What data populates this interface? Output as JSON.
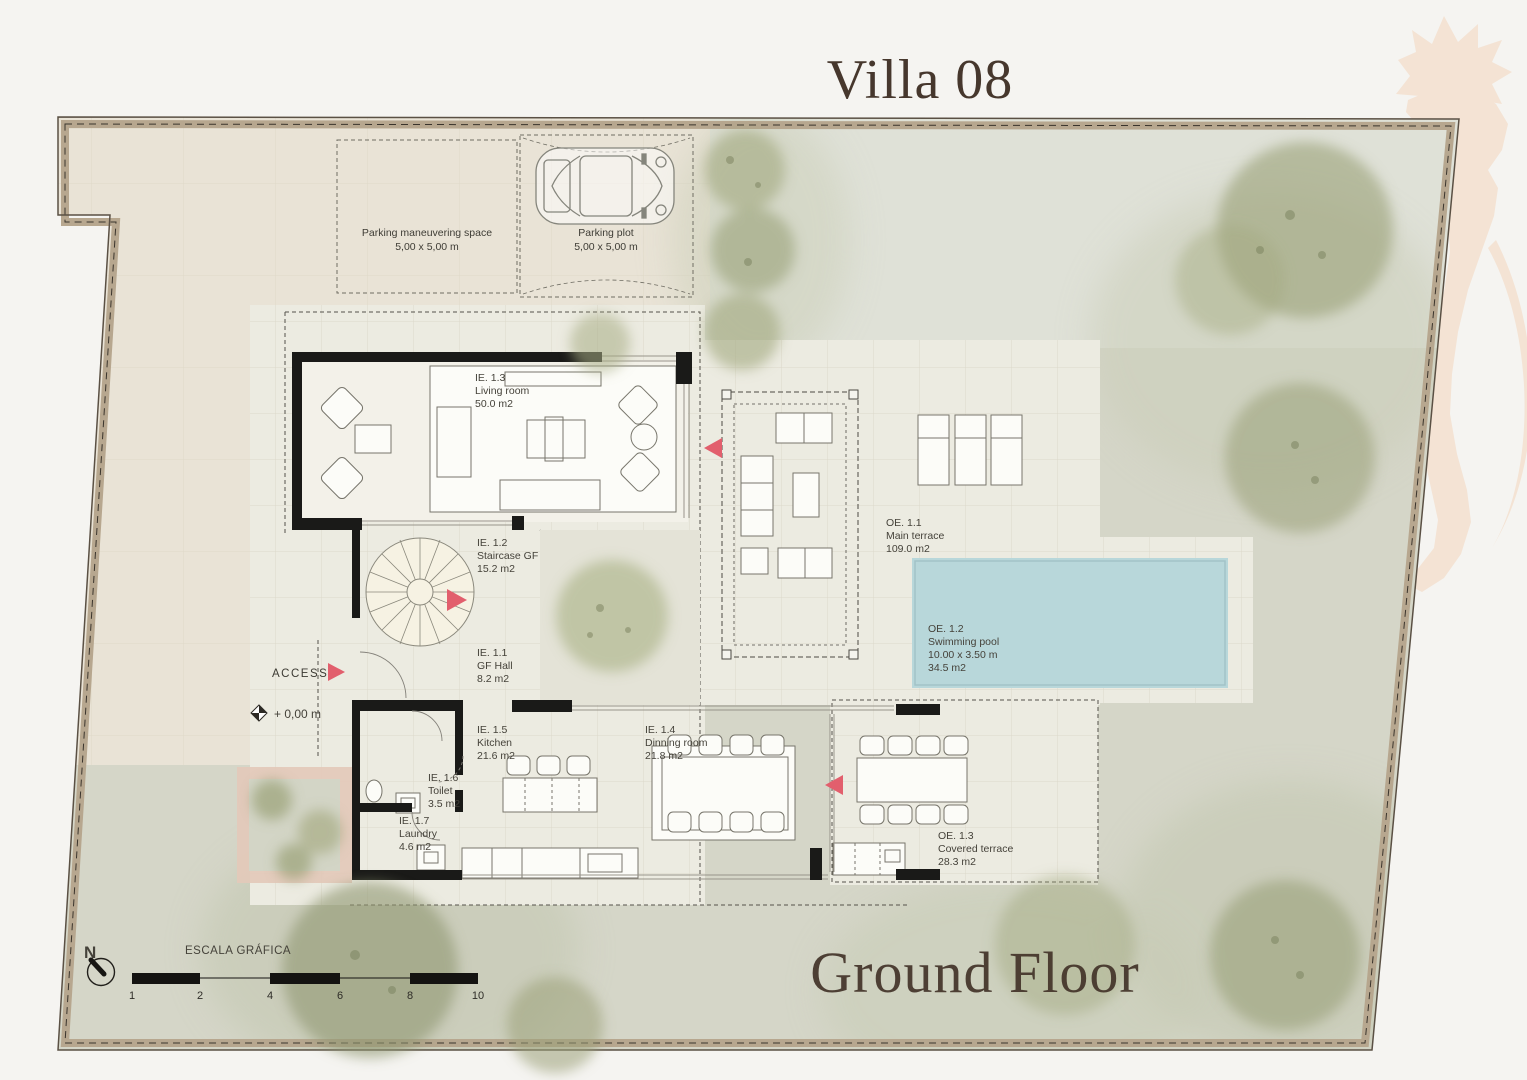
{
  "title": "Villa 08",
  "floor_label": "Ground Floor",
  "logo": "seahorse-watermark",
  "parking": {
    "maneuvering": {
      "name": "Parking maneuvering space",
      "size": "5,00 x 5,00 m"
    },
    "plot": {
      "name": "Parking plot",
      "size": "5,00 x 5,00 m"
    }
  },
  "rooms": {
    "hall": {
      "code": "IE. 1.1",
      "name": "GF Hall",
      "area": "8.2 m2"
    },
    "staircase": {
      "code": "IE. 1.2",
      "name": "Staircase GF",
      "area": "15.2 m2"
    },
    "living": {
      "code": "IE. 1.3",
      "name": "Living room",
      "area": "50.0 m2"
    },
    "dining": {
      "code": "IE. 1.4",
      "name": "Dinning room",
      "area": "21.8 m2"
    },
    "kitchen": {
      "code": "IE. 1.5",
      "name": "Kitchen",
      "area": "21.6 m2"
    },
    "toilet": {
      "code": "IE. 1.6",
      "name": "Toilet",
      "area": "3.5 m2"
    },
    "laundry": {
      "code": "IE. 1.7",
      "name": "Laundry",
      "area": "4.6 m2"
    }
  },
  "outdoor": {
    "main_terrace": {
      "code": "OE. 1.1",
      "name": "Main terrace",
      "area": "109.0 m2"
    },
    "swimming_pool": {
      "code": "OE. 1.2",
      "name": "Swimming pool",
      "size": "10.00 x 3.50 m",
      "area": "34.5 m2"
    },
    "covered_terrace": {
      "code": "OE. 1.3",
      "name": "Covered terrace",
      "area": "28.3 m2"
    }
  },
  "annotations": {
    "access": "ACCESS",
    "level": "+ 0,00 m",
    "north": "N"
  },
  "scale_bar": {
    "label": "ESCALA GRÁFICA",
    "ticks": [
      "1",
      "2",
      "4",
      "6",
      "8",
      "10"
    ]
  },
  "colors": {
    "accent_arrow": "#e25f6d",
    "pool_water": "#b8d7da",
    "paving": "#ecebe1",
    "driveway": "#e9e3d6",
    "garden": "#d5d6c8",
    "wall": "#1a1a18",
    "boundary_band": "#b7a78f",
    "title_brown": "#46372d",
    "watermark_peach": "#f4e3d4"
  }
}
